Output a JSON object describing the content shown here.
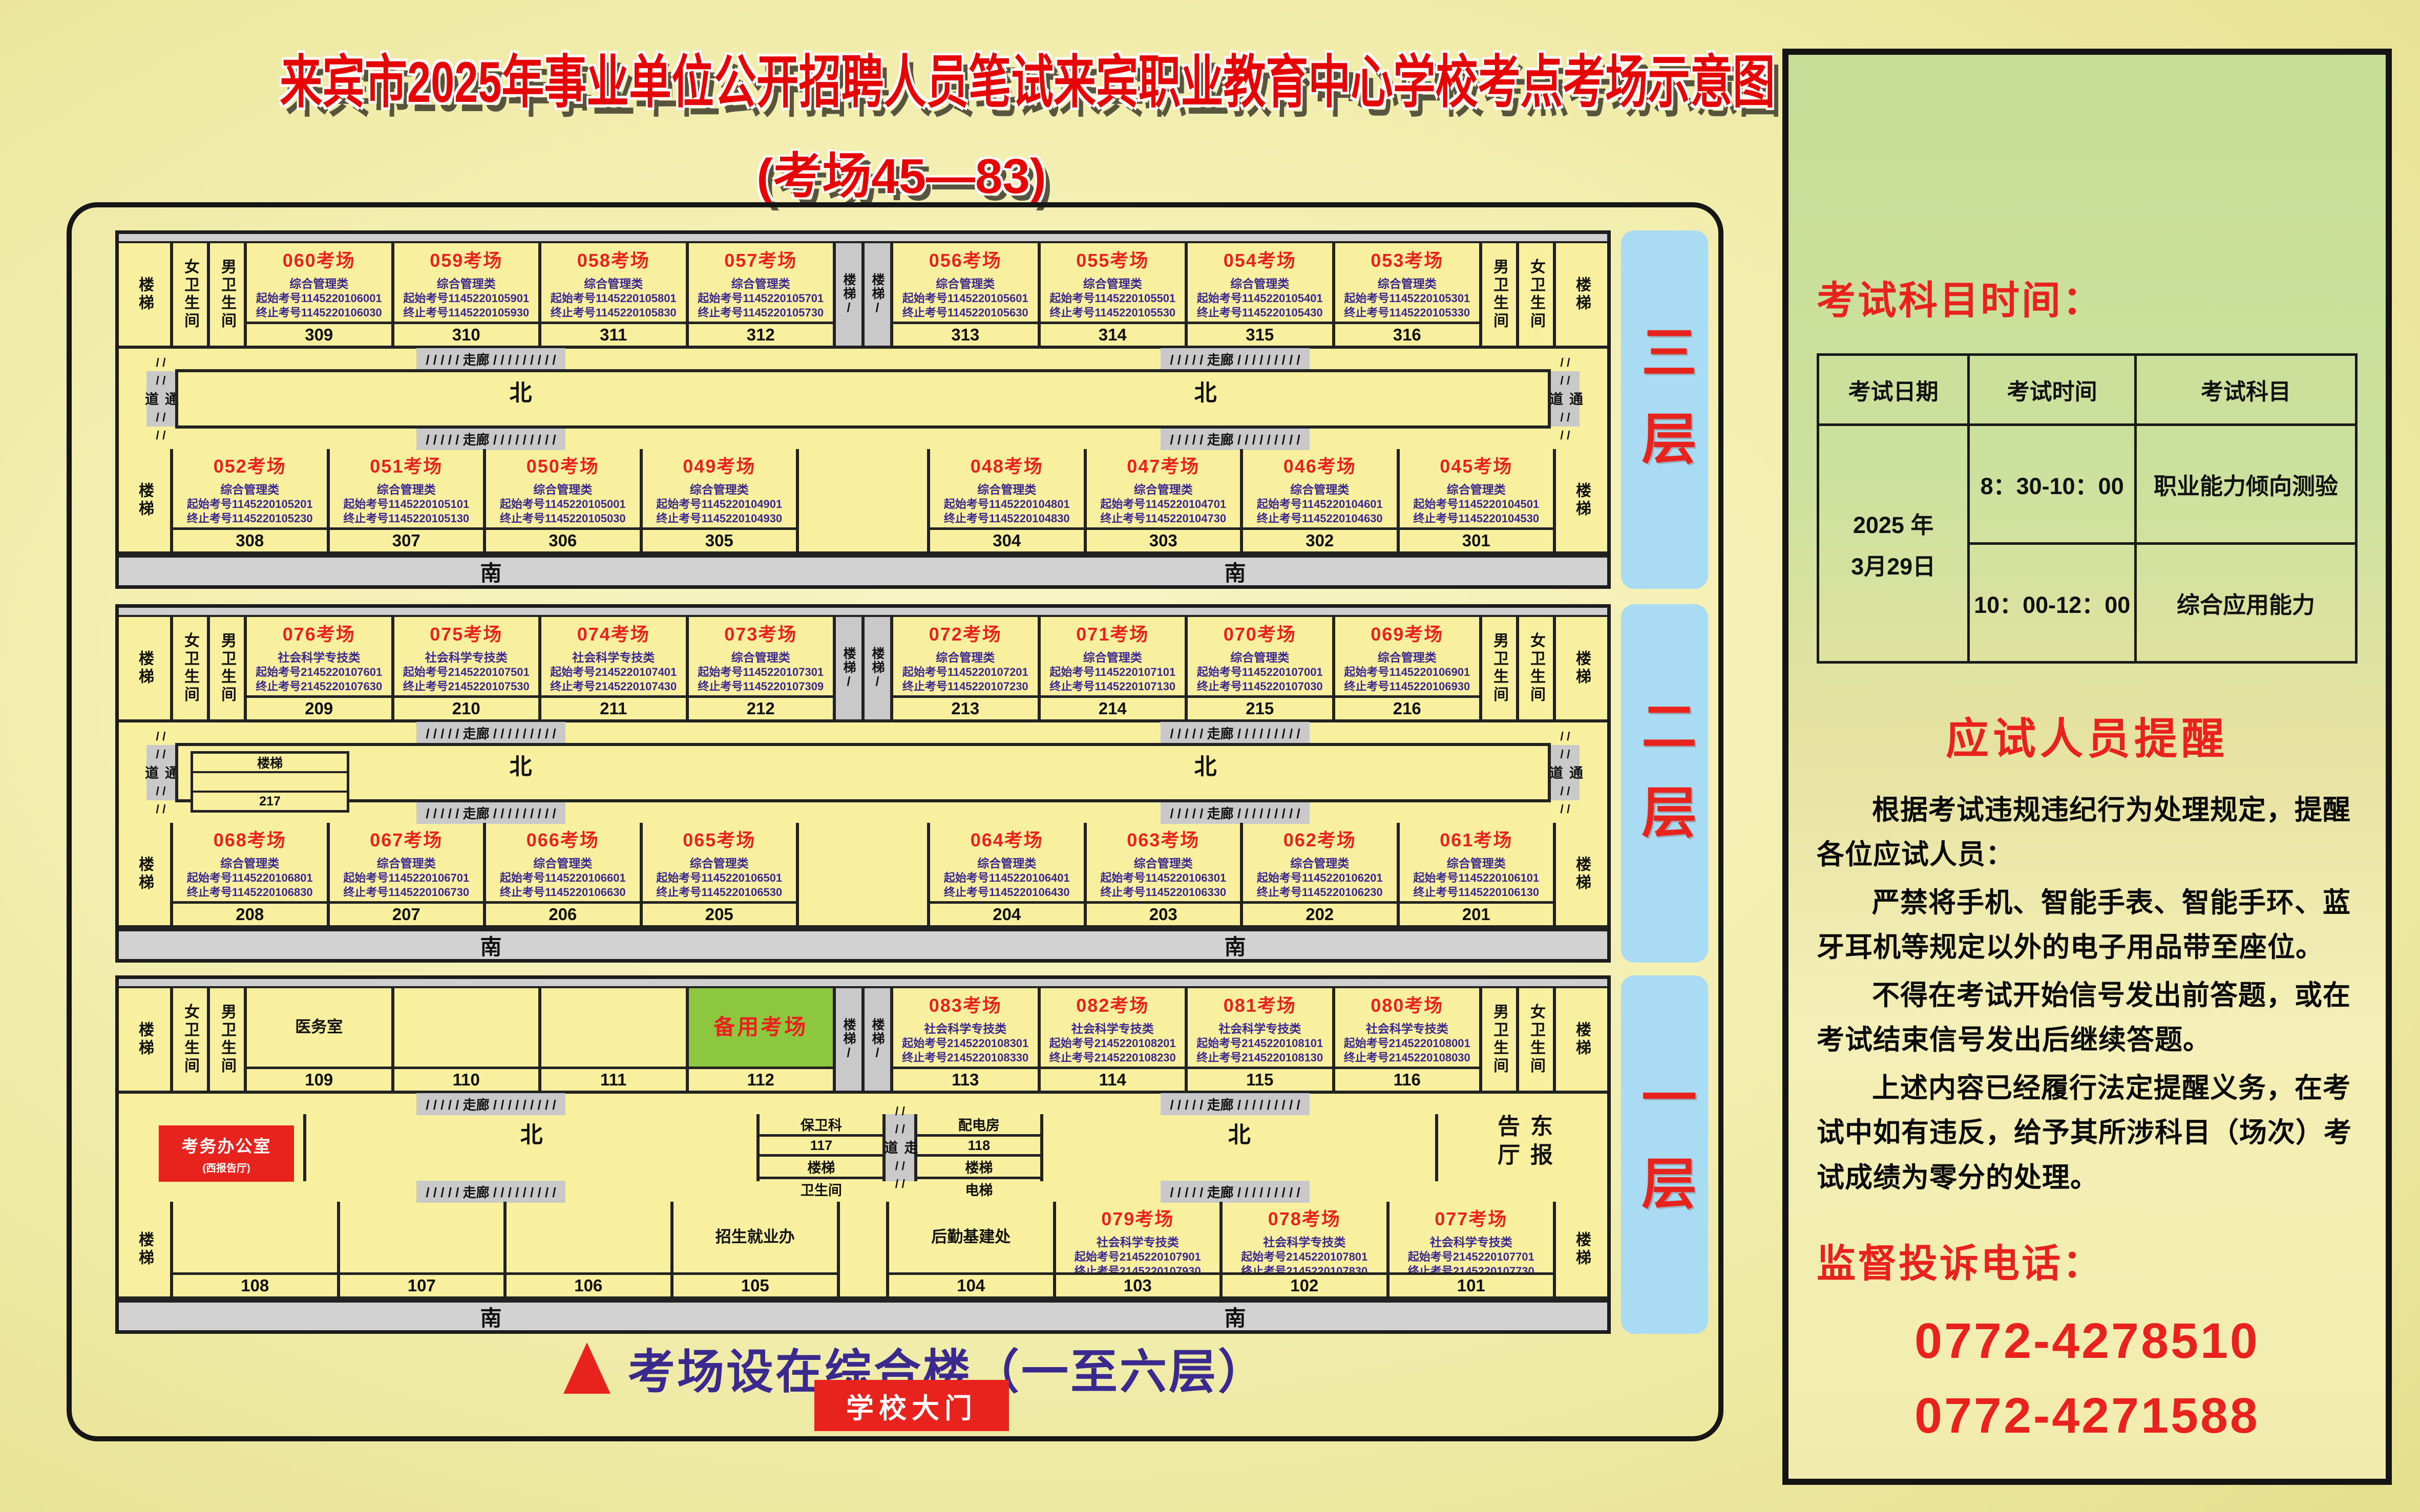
{
  "title": {
    "main": "来宾市2025年事业单位公开招聘人员笔试来宾职业教育中心学校考点考场示意图",
    "sub": "(考场45—83)"
  },
  "caption": {
    "text": "考场设在综合楼（一至六层）"
  },
  "gate": {
    "label": "学校大门"
  },
  "colors": {
    "accent_red": "#e8231d",
    "indigo": "#3a2790",
    "level_bar_blue": "#a9dcf2",
    "reserve_green": "#8dc63f",
    "room_yellow": "#f8f09e"
  },
  "common": {
    "stair": "楼梯",
    "stair_slash": "楼梯/",
    "female_wc": "女卫生间",
    "male_wc": "男卫生间",
    "passage": "通道",
    "walkway": "走道",
    "corridor": "/ / / / / 走廊 / / / / / / / / /",
    "slash_pair": "/ /",
    "north": "北",
    "south": "南",
    "elevator": "电梯",
    "wc": "卫生间",
    "security": "保卫科",
    "power_room": "配电房",
    "east_hall": "东报告厅",
    "logistics": "后勤基建处",
    "admissions": "招生就业办",
    "medical": "医务室",
    "reserve_room": "备用考场",
    "exam_office": "考务办公室",
    "west_hall": "(西报告厅)"
  },
  "floors": [
    {
      "name": "三层",
      "type": "standard",
      "top_left": [
        {
          "name": "060考场",
          "cat": "综合管理类",
          "start": "起始考号1145220106001",
          "end": "终止考号1145220106030",
          "num": "309"
        },
        {
          "name": "059考场",
          "cat": "综合管理类",
          "start": "起始考号1145220105901",
          "end": "终止考号1145220105930",
          "num": "310"
        },
        {
          "name": "058考场",
          "cat": "综合管理类",
          "start": "起始考号1145220105801",
          "end": "终止考号1145220105830",
          "num": "311"
        },
        {
          "name": "057考场",
          "cat": "综合管理类",
          "start": "起始考号1145220105701",
          "end": "终止考号1145220105730",
          "num": "312"
        }
      ],
      "top_right": [
        {
          "name": "056考场",
          "cat": "综合管理类",
          "start": "起始考号1145220105601",
          "end": "终止考号1145220105630",
          "num": "313"
        },
        {
          "name": "055考场",
          "cat": "综合管理类",
          "start": "起始考号1145220105501",
          "end": "终止考号1145220105530",
          "num": "314"
        },
        {
          "name": "054考场",
          "cat": "综合管理类",
          "start": "起始考号1145220105401",
          "end": "终止考号1145220105430",
          "num": "315"
        },
        {
          "name": "053考场",
          "cat": "综合管理类",
          "start": "起始考号1145220105301",
          "end": "终止考号1145220105330",
          "num": "316"
        }
      ],
      "bottom_left": [
        {
          "name": "052考场",
          "cat": "综合管理类",
          "start": "起始考号1145220105201",
          "end": "终止考号1145220105230",
          "num": "308"
        },
        {
          "name": "051考场",
          "cat": "综合管理类",
          "start": "起始考号1145220105101",
          "end": "终止考号1145220105130",
          "num": "307"
        },
        {
          "name": "050考场",
          "cat": "综合管理类",
          "start": "起始考号1145220105001",
          "end": "终止考号1145220105030",
          "num": "306"
        },
        {
          "name": "049考场",
          "cat": "综合管理类",
          "start": "起始考号1145220104901",
          "end": "终止考号1145220104930",
          "num": "305"
        }
      ],
      "bottom_right": [
        {
          "name": "048考场",
          "cat": "综合管理类",
          "start": "起始考号1145220104801",
          "end": "终止考号1145220104830",
          "num": "304"
        },
        {
          "name": "047考场",
          "cat": "综合管理类",
          "start": "起始考号1145220104701",
          "end": "终止考号1145220104730",
          "num": "303"
        },
        {
          "name": "046考场",
          "cat": "综合管理类",
          "start": "起始考号1145220104601",
          "end": "终止考号1145220104630",
          "num": "302"
        },
        {
          "name": "045考场",
          "cat": "综合管理类",
          "start": "起始考号1145220104501",
          "end": "终止考号1145220104530",
          "num": "301"
        }
      ]
    },
    {
      "name": "二层",
      "type": "standard",
      "mid_stair": {
        "label": "楼梯",
        "num": "217"
      },
      "top_left": [
        {
          "name": "076考场",
          "cat": "社会科学专技类",
          "start": "起始考号2145220107601",
          "end": "终止考号2145220107630",
          "num": "209"
        },
        {
          "name": "075考场",
          "cat": "社会科学专技类",
          "start": "起始考号2145220107501",
          "end": "终止考号2145220107530",
          "num": "210"
        },
        {
          "name": "074考场",
          "cat": "社会科学专技类",
          "start": "起始考号2145220107401",
          "end": "终止考号2145220107430",
          "num": "211"
        },
        {
          "name": "073考场",
          "cat": "综合管理类",
          "start": "起始考号1145220107301",
          "end": "终止考号1145220107309",
          "num": "212"
        }
      ],
      "top_right": [
        {
          "name": "072考场",
          "cat": "综合管理类",
          "start": "起始考号1145220107201",
          "end": "终止考号1145220107230",
          "num": "213"
        },
        {
          "name": "071考场",
          "cat": "综合管理类",
          "start": "起始考号1145220107101",
          "end": "终止考号1145220107130",
          "num": "214"
        },
        {
          "name": "070考场",
          "cat": "综合管理类",
          "start": "起始考号1145220107001",
          "end": "终止考号1145220107030",
          "num": "215"
        },
        {
          "name": "069考场",
          "cat": "综合管理类",
          "start": "起始考号1145220106901",
          "end": "终止考号1145220106930",
          "num": "216"
        }
      ],
      "bottom_left": [
        {
          "name": "068考场",
          "cat": "综合管理类",
          "start": "起始考号1145220106801",
          "end": "终止考号1145220106830",
          "num": "208"
        },
        {
          "name": "067考场",
          "cat": "综合管理类",
          "start": "起始考号1145220106701",
          "end": "终止考号1145220106730",
          "num": "207"
        },
        {
          "name": "066考场",
          "cat": "综合管理类",
          "start": "起始考号1145220106601",
          "end": "终止考号1145220106630",
          "num": "206"
        },
        {
          "name": "065考场",
          "cat": "综合管理类",
          "start": "起始考号1145220106501",
          "end": "终止考号1145220106530",
          "num": "205"
        }
      ],
      "bottom_right": [
        {
          "name": "064考场",
          "cat": "综合管理类",
          "start": "起始考号1145220106401",
          "end": "终止考号1145220106430",
          "num": "204"
        },
        {
          "name": "063考场",
          "cat": "综合管理类",
          "start": "起始考号1145220106301",
          "end": "终止考号1145220106330",
          "num": "203"
        },
        {
          "name": "062考场",
          "cat": "综合管理类",
          "start": "起始考号1145220106201",
          "end": "终止考号1145220106230",
          "num": "202"
        },
        {
          "name": "061考场",
          "cat": "综合管理类",
          "start": "起始考号1145220106101",
          "end": "终止考号1145220106130",
          "num": "201"
        }
      ]
    },
    {
      "name": "一层",
      "type": "ground",
      "top_named": [
        {
          "title": "医务室",
          "num": "109"
        },
        {
          "title": "",
          "num": "110"
        },
        {
          "title": "",
          "num": "111"
        },
        {
          "title": "备用考场",
          "num": "112",
          "green": true
        }
      ],
      "top_right": [
        {
          "name": "083考场",
          "cat": "社会科学专技类",
          "start": "起始考号2145220108301",
          "end": "终止考号2145220108330",
          "num": "113"
        },
        {
          "name": "082考场",
          "cat": "社会科学专技类",
          "start": "起始考号2145220108201",
          "end": "终止考号2145220108230",
          "num": "114"
        },
        {
          "name": "081考场",
          "cat": "社会科学专技类",
          "start": "起始考号2145220108101",
          "end": "终止考号2145220108130",
          "num": "115"
        },
        {
          "name": "080考场",
          "cat": "社会科学专技类",
          "start": "起始考号2145220108001",
          "end": "终止考号2145220108030",
          "num": "116"
        }
      ],
      "mid": {
        "security_num": "117",
        "power_num": "118"
      },
      "bottom_named": [
        {
          "title": "",
          "num": "108"
        },
        {
          "title": "",
          "num": "107"
        },
        {
          "title": "",
          "num": "106"
        },
        {
          "title": "招生就业办",
          "num": "105"
        }
      ],
      "bottom_logistics": {
        "title": "后勤基建处",
        "num": "104"
      },
      "bottom_right": [
        {
          "name": "079考场",
          "cat": "社会科学专技类",
          "start": "起始考号2145220107901",
          "end": "终止考号2145220107930",
          "num": "103"
        },
        {
          "name": "078考场",
          "cat": "社会科学专技类",
          "start": "起始考号2145220107801",
          "end": "终止考号2145220107830",
          "num": "102"
        },
        {
          "name": "077考场",
          "cat": "社会科学专技类",
          "start": "起始考号2145220107701",
          "end": "终止考号2145220107730",
          "num": "101"
        }
      ]
    }
  ],
  "sidebar": {
    "schedule_title": "考试科目时间：",
    "table": {
      "headers": [
        "考试日期",
        "考试时间",
        "考试科目"
      ],
      "date_lines": [
        "2025 年",
        "3月29日"
      ],
      "rows": [
        {
          "time": "8：30-10：00",
          "subject": "职业能力倾向测验"
        },
        {
          "time": "10：00-12：00",
          "subject": "综合应用能力"
        }
      ]
    },
    "notice_title": "应试人员提醒",
    "paragraphs": [
      "根据考试违规违纪行为处理规定，提醒各位应试人员：",
      "严禁将手机、智能手表、智能手环、蓝牙耳机等规定以外的电子用品带至座位。",
      "不得在考试开始信号发出前答题，或在考试结束信号发出后继续答题。",
      "上述内容已经履行法定提醒义务，在考试中如有违反，给予其所涉科目（场次）考试成绩为零分的处理。"
    ],
    "phone_title": "监督投诉电话：",
    "phones": [
      "0772-4278510",
      "0772-4271588"
    ]
  }
}
